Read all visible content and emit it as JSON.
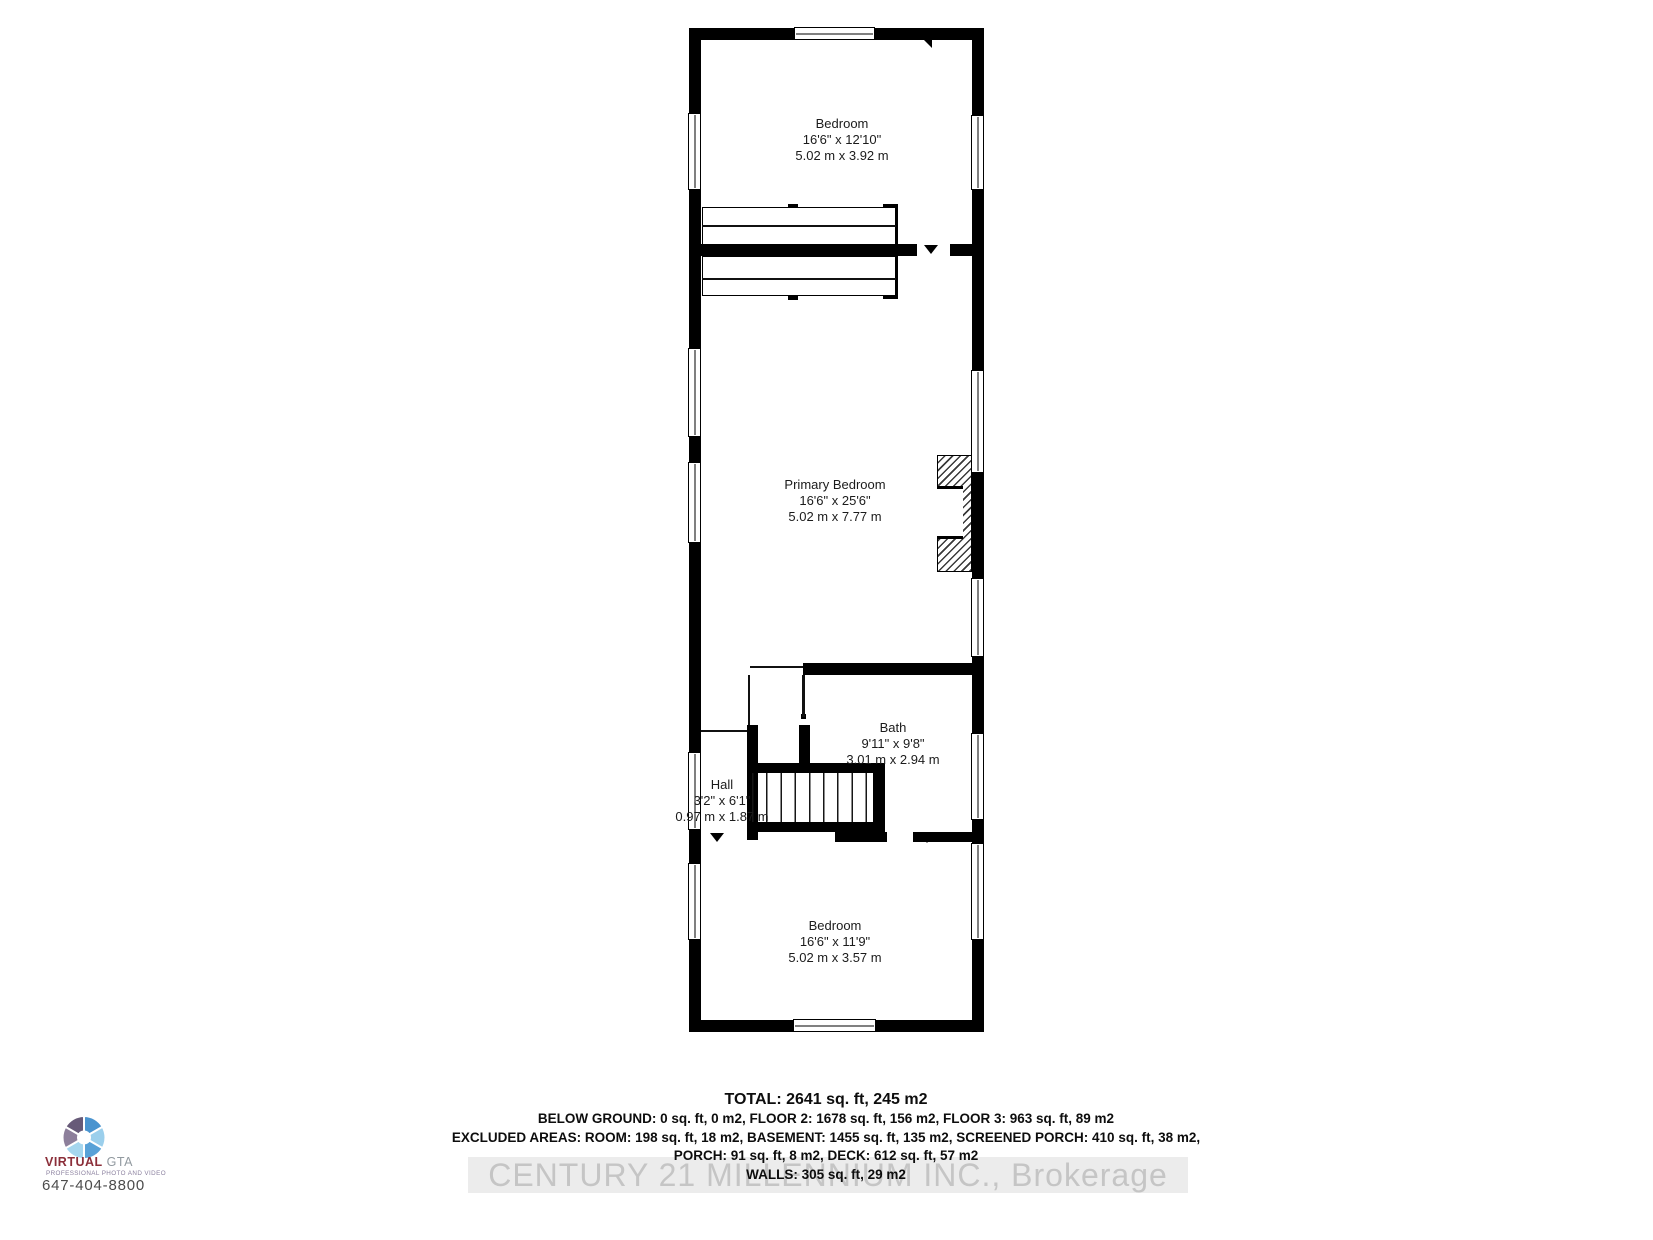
{
  "floor_plan": {
    "rooms": [
      {
        "id": "bedroom-top",
        "name": "Bedroom",
        "dims_imperial": "16'6\" x 12'10\"",
        "dims_metric": "5.02 m x 3.92 m"
      },
      {
        "id": "primary-bedroom",
        "name": "Primary Bedroom",
        "dims_imperial": "16'6\" x 25'6\"",
        "dims_metric": "5.02 m x 7.77 m"
      },
      {
        "id": "bath",
        "name": "Bath",
        "dims_imperial": "9'11\" x 9'8\"",
        "dims_metric": "3.01 m x 2.94 m"
      },
      {
        "id": "hall",
        "name": "Hall",
        "dims_imperial": "3'2\" x 6'1\"",
        "dims_metric": "0.97 m x 1.87 m"
      },
      {
        "id": "bedroom-bottom",
        "name": "Bedroom",
        "dims_imperial": "16'6\" x 11'9\"",
        "dims_metric": "5.02 m x 3.57 m"
      }
    ]
  },
  "area_summary": {
    "total": "TOTAL: 2641 sq. ft, 245 m2",
    "floors": "BELOW GROUND: 0 sq. ft, 0 m2, FLOOR 2: 1678 sq. ft, 156 m2, FLOOR 3: 963 sq. ft, 89 m2",
    "excluded_1": "EXCLUDED AREAS: ROOM: 198 sq. ft, 18 m2, BASEMENT: 1455 sq. ft, 135 m2, SCREENED PORCH: 410 sq. ft, 38 m2,",
    "excluded_2": "PORCH: 91 sq. ft, 8 m2, DECK: 612 sq. ft, 57 m2",
    "walls": "WALLS: 305 sq. ft, 29 m2"
  },
  "watermark": {
    "text": "CENTURY 21 MILLENNIUM INC., Brokerage",
    "text_color": "#c5c5c5",
    "band_color": "#ececec"
  },
  "logo": {
    "icon": "aperture-icon",
    "brand_primary": "VIRTUAL",
    "brand_secondary": " GTA",
    "tagline": "PROFESSIONAL PHOTO AND VIDEO",
    "phone": "647-404-8800",
    "colors": {
      "brand_primary": "#8b2e39",
      "brand_secondary": "#929aa0",
      "tagline": "#8a7f9e",
      "phone": "#4c4c4c",
      "blade_1": "#4a94cf",
      "blade_2": "#9bcfec",
      "blade_3": "#58a1d7",
      "blade_4": "#a5d6ee",
      "blade_5": "#8d7f9b",
      "blade_6": "#675a78"
    }
  }
}
